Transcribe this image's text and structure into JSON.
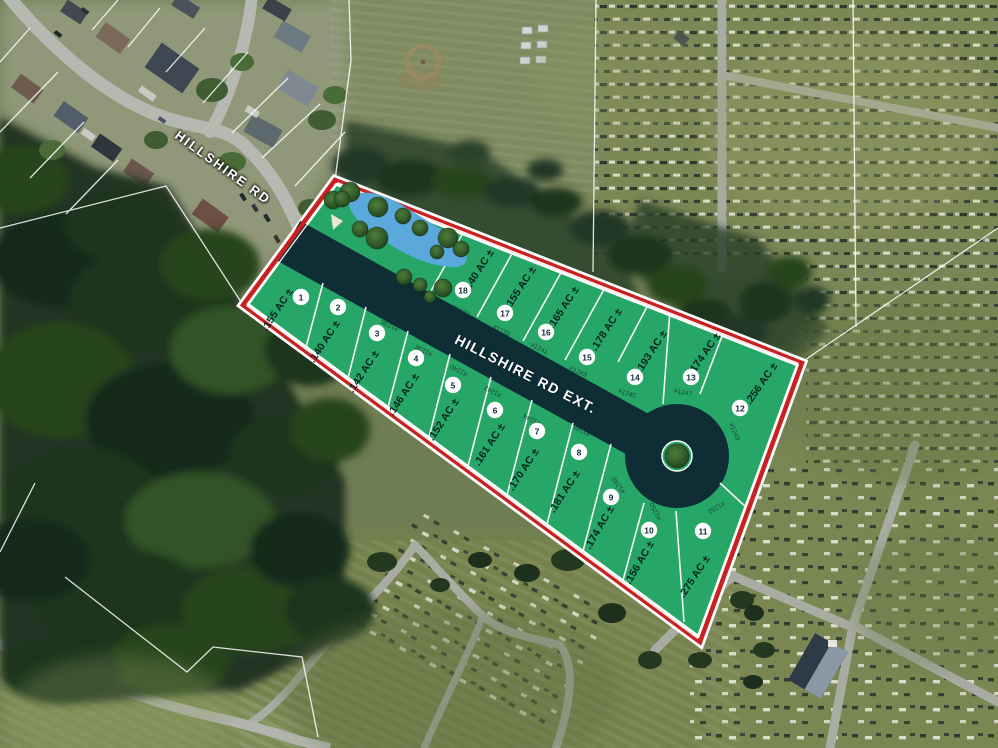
{
  "streets": {
    "existing": "HILLSHIRE RD",
    "extension": "HILLSHIRE RD EXT."
  },
  "colors": {
    "lot_green": "#26a667",
    "road_dark": "#0e2d35",
    "boundary_red": "#c92121",
    "line_white": "#ffffff",
    "pond_blue": "#5aa9da",
    "label_dark": "#08231d"
  },
  "plat": {
    "site_boundary": [
      [
        335,
        180
      ],
      [
        802,
        363
      ],
      [
        700,
        642
      ],
      [
        243,
        305
      ]
    ],
    "road": {
      "start": [
        289,
        241
      ],
      "end": [
        677,
        456
      ],
      "width": 46,
      "culdesac_radius": 52,
      "island_radius": 15
    },
    "pond_path": "M 350,208 C 346,198 357,191 371,193 C 389,196 402,205 418,215 C 436,226 456,238 464,250 C 470,259 466,268 452,267 C 432,266 412,258 394,247 C 376,236 355,222 350,208 Z",
    "entrance_wedge": [
      [
        331,
        214
      ],
      [
        343,
        221
      ],
      [
        333,
        230
      ]
    ],
    "trees_site": [
      [
        333,
        200,
        9
      ],
      [
        350,
        192,
        10
      ],
      [
        342,
        199,
        8
      ],
      [
        378,
        207,
        10
      ],
      [
        403,
        216,
        8
      ],
      [
        360,
        229,
        8
      ],
      [
        377,
        238,
        11
      ],
      [
        420,
        228,
        8
      ],
      [
        448,
        238,
        10
      ],
      [
        461,
        249,
        8
      ],
      [
        437,
        252,
        7
      ],
      [
        404,
        277,
        8
      ],
      [
        420,
        285,
        7
      ],
      [
        443,
        288,
        9
      ],
      [
        430,
        297,
        6
      ]
    ],
    "island_tree": [
      677,
      456,
      12
    ],
    "dividers": [
      [
        323,
        283,
        305,
        351
      ],
      [
        366,
        307,
        347,
        382
      ],
      [
        408,
        331,
        387,
        411
      ],
      [
        450,
        354,
        428,
        441
      ],
      [
        491,
        377,
        467,
        470
      ],
      [
        532,
        400,
        506,
        499
      ],
      [
        573,
        423,
        546,
        528
      ],
      [
        611,
        444,
        582,
        555
      ],
      [
        644,
        503,
        622,
        584
      ],
      [
        676,
        511,
        684,
        622
      ],
      [
        720,
        483,
        748,
        509
      ],
      [
        431,
        291,
        464,
        231
      ],
      [
        477,
        317,
        514,
        250
      ],
      [
        523,
        341,
        563,
        269
      ],
      [
        565,
        360,
        607,
        284
      ],
      [
        618,
        362,
        649,
        303
      ],
      [
        663,
        404,
        670,
        310
      ],
      [
        700,
        394,
        724,
        331
      ]
    ],
    "lots": [
      {
        "number": "1",
        "parcel_id": "#1232",
        "acreage": ".155 AC ±",
        "badge": [
          301,
          297
        ],
        "acre_pos": [
          278,
          310,
          -57
        ],
        "pid_pos": [
          318,
          268,
          207
        ]
      },
      {
        "number": "2",
        "parcel_id": "#1234",
        "acreage": ".140 AC ±",
        "badge": [
          338,
          307
        ],
        "acre_pos": [
          325,
          342,
          -57
        ],
        "pid_pos": [
          349,
          295,
          207
        ]
      },
      {
        "number": "3",
        "parcel_id": "#1236",
        "acreage": ".142 AC ±",
        "badge": [
          377,
          333
        ],
        "acre_pos": [
          364,
          372,
          -57
        ],
        "pid_pos": [
          390,
          325,
          207
        ]
      },
      {
        "number": "4",
        "parcel_id": "#1238",
        "acreage": ".146 AC ±",
        "badge": [
          416,
          358
        ],
        "acre_pos": [
          404,
          395,
          -57
        ],
        "pid_pos": [
          424,
          350,
          207
        ]
      },
      {
        "number": "5",
        "parcel_id": "#1240",
        "acreage": ".152 AC ±",
        "badge": [
          453,
          385
        ],
        "acre_pos": [
          444,
          420,
          -57
        ],
        "pid_pos": [
          459,
          370,
          207
        ]
      },
      {
        "number": "6",
        "parcel_id": "#1242",
        "acreage": ".161 AC ±",
        "badge": [
          495,
          410
        ],
        "acre_pos": [
          490,
          445,
          -57
        ],
        "pid_pos": [
          493,
          391,
          207
        ]
      },
      {
        "number": "7",
        "parcel_id": "#1244",
        "acreage": ".170 AC ±",
        "badge": [
          537,
          431
        ],
        "acre_pos": [
          524,
          470,
          -57
        ],
        "pid_pos": [
          532,
          419,
          207
        ]
      },
      {
        "number": "8",
        "parcel_id": "#1246",
        "acreage": ".181 AC ±",
        "badge": [
          579,
          452
        ],
        "acre_pos": [
          565,
          492,
          -57
        ],
        "pid_pos": [
          582,
          430,
          207
        ]
      },
      {
        "number": "9",
        "parcel_id": "#1248",
        "acreage": ".174 AC ±",
        "badge": [
          611,
          497
        ],
        "acre_pos": [
          600,
          528,
          -60
        ],
        "pid_pos": [
          619,
          485,
          235
        ]
      },
      {
        "number": "10",
        "parcel_id": "#1250",
        "acreage": ".156 AC ±",
        "badge": [
          649,
          530
        ],
        "acre_pos": [
          640,
          563,
          -60
        ],
        "pid_pos": [
          656,
          511,
          243
        ]
      },
      {
        "number": "11",
        "parcel_id": "#1252",
        "acreage": ".275 AC ±",
        "badge": [
          703,
          531
        ],
        "acre_pos": [
          695,
          577,
          -57
        ],
        "pid_pos": [
          716,
          507,
          150
        ]
      },
      {
        "number": "12",
        "parcel_id": "#1249",
        "acreage": ".256 AC ±",
        "badge": [
          740,
          408
        ],
        "acre_pos": [
          762,
          384,
          -55
        ],
        "pid_pos": [
          734,
          432,
          66
        ]
      },
      {
        "number": "13",
        "parcel_id": "#1247",
        "acreage": ".174 AC ±",
        "badge": [
          691,
          377
        ],
        "acre_pos": [
          705,
          354,
          -55
        ],
        "pid_pos": [
          683,
          393,
          10
        ]
      },
      {
        "number": "14",
        "parcel_id": "#1245",
        "acreage": ".193 AC ±",
        "badge": [
          635,
          377
        ],
        "acre_pos": [
          652,
          352,
          -57
        ],
        "pid_pos": [
          627,
          394,
          18
        ]
      },
      {
        "number": "15",
        "parcel_id": "#1243",
        "acreage": ".178 AC ±",
        "badge": [
          587,
          357
        ],
        "acre_pos": [
          607,
          330,
          -57
        ],
        "pid_pos": [
          578,
          372,
          25
        ]
      },
      {
        "number": "16",
        "parcel_id": "#1241",
        "acreage": ".165 AC ±",
        "badge": [
          546,
          332
        ],
        "acre_pos": [
          564,
          308,
          -57
        ],
        "pid_pos": [
          539,
          349,
          27
        ]
      },
      {
        "number": "17",
        "parcel_id": "#1239",
        "acreage": ".155 AC ±",
        "badge": [
          505,
          313
        ],
        "acre_pos": [
          521,
          288,
          -57
        ],
        "pid_pos": [
          501,
          331,
          27
        ]
      },
      {
        "number": "18",
        "parcel_id": "#1237",
        "acreage": ".140 AC ±",
        "badge": [
          463,
          290
        ],
        "acre_pos": [
          479,
          271,
          -57
        ],
        "pid_pos": [
          460,
          311,
          27
        ]
      }
    ]
  }
}
